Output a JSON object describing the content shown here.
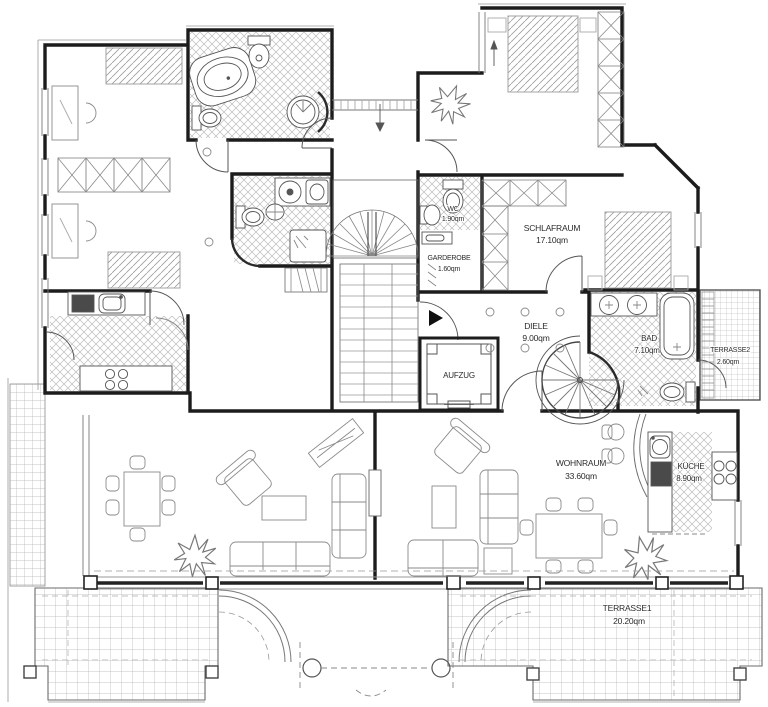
{
  "document": {
    "type": "architectural-floor-plan",
    "units": "qm"
  },
  "colors": {
    "wall": "#1c1c1c",
    "line_medium": "#4a4a4a",
    "line_light": "#9a9a9a",
    "hatch": "#b9b9b9",
    "appliance_dark": "#4a4a4a",
    "background": "#ffffff"
  },
  "rooms": [
    {
      "id": "wc",
      "name": "WC",
      "area": "1.90qm"
    },
    {
      "id": "garderobe",
      "name": "GARDEROBE",
      "area": "1.60qm"
    },
    {
      "id": "schlafraum",
      "name": "SCHLAFRAUM",
      "area": "17.10qm"
    },
    {
      "id": "diele",
      "name": "DIELE",
      "area": "9.00qm"
    },
    {
      "id": "bad",
      "name": "BAD",
      "area": "7.10qm"
    },
    {
      "id": "terrasse2",
      "name": "TERRASSE2",
      "area": "2.60qm"
    },
    {
      "id": "wohnraum",
      "name": "WOHNRAUM",
      "area": "33.60qm"
    },
    {
      "id": "kueche",
      "name": "KÜCHE",
      "area": "8.90qm"
    },
    {
      "id": "terrasse1",
      "name": "TERRASSE1",
      "area": "20.20qm"
    },
    {
      "id": "aufzug",
      "name": "AUFZUG",
      "area": ""
    }
  ]
}
